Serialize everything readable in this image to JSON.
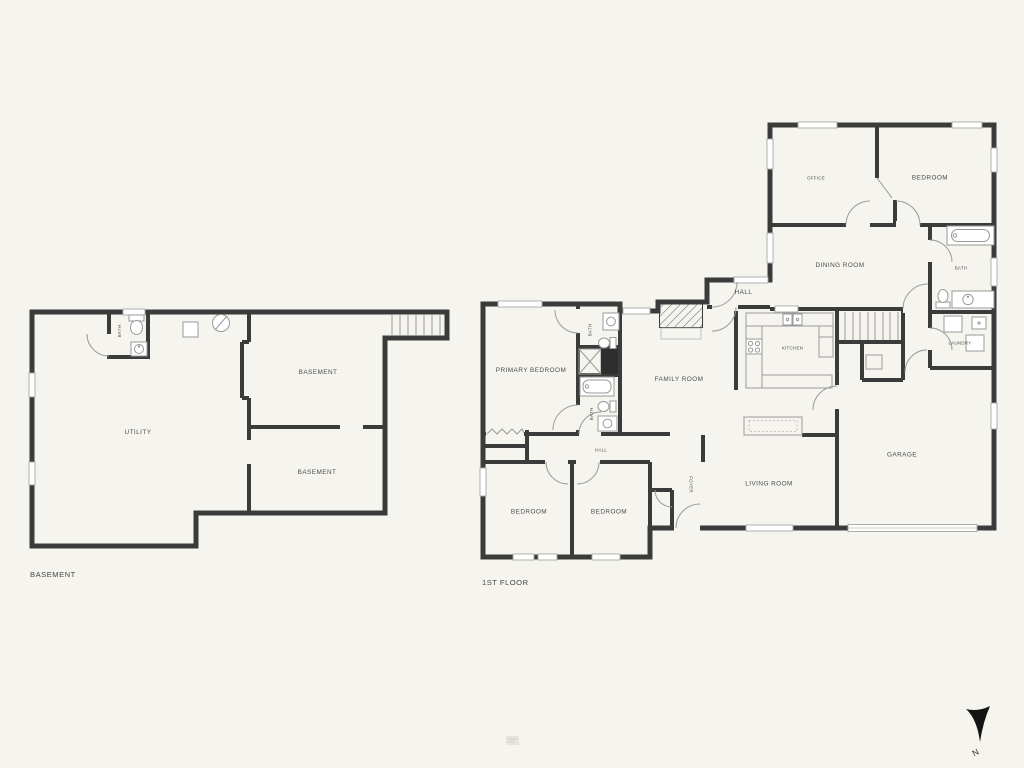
{
  "colors": {
    "background": "#f5f4ee",
    "walls": "#3b3b3b",
    "fixture_lines": "#9a9a9a",
    "labels": "#4d4d4d",
    "compass": "#141414"
  },
  "plans": {
    "basement": {
      "title": "BASEMENT",
      "rooms": {
        "utility": "UTILITY",
        "basement_a": "BASEMENT",
        "basement_b": "BASEMENT",
        "bath": "BATH"
      }
    },
    "first_floor": {
      "title": "1ST FLOOR",
      "rooms": {
        "primary_bedroom": "PRIMARY BEDROOM",
        "bath_primary": "BATH",
        "bath_hall": "BATH",
        "family_room": "FAMILY ROOM",
        "hall_upper": "HALL",
        "kitchen": "KITCHEN",
        "dining_room": "DINING ROOM",
        "office": "OFFICE",
        "bedroom_upper": "BEDROOM",
        "bath_upper_right": "BATH",
        "laundry": "LAUNDRY",
        "garage": "GARAGE",
        "living_room": "LIVING ROOM",
        "foyer": "FOYER",
        "hall_bedrooms": "HALL",
        "bedroom_left": "BEDROOM",
        "bedroom_middle": "BEDROOM"
      }
    }
  },
  "compass": {
    "label": "N"
  }
}
